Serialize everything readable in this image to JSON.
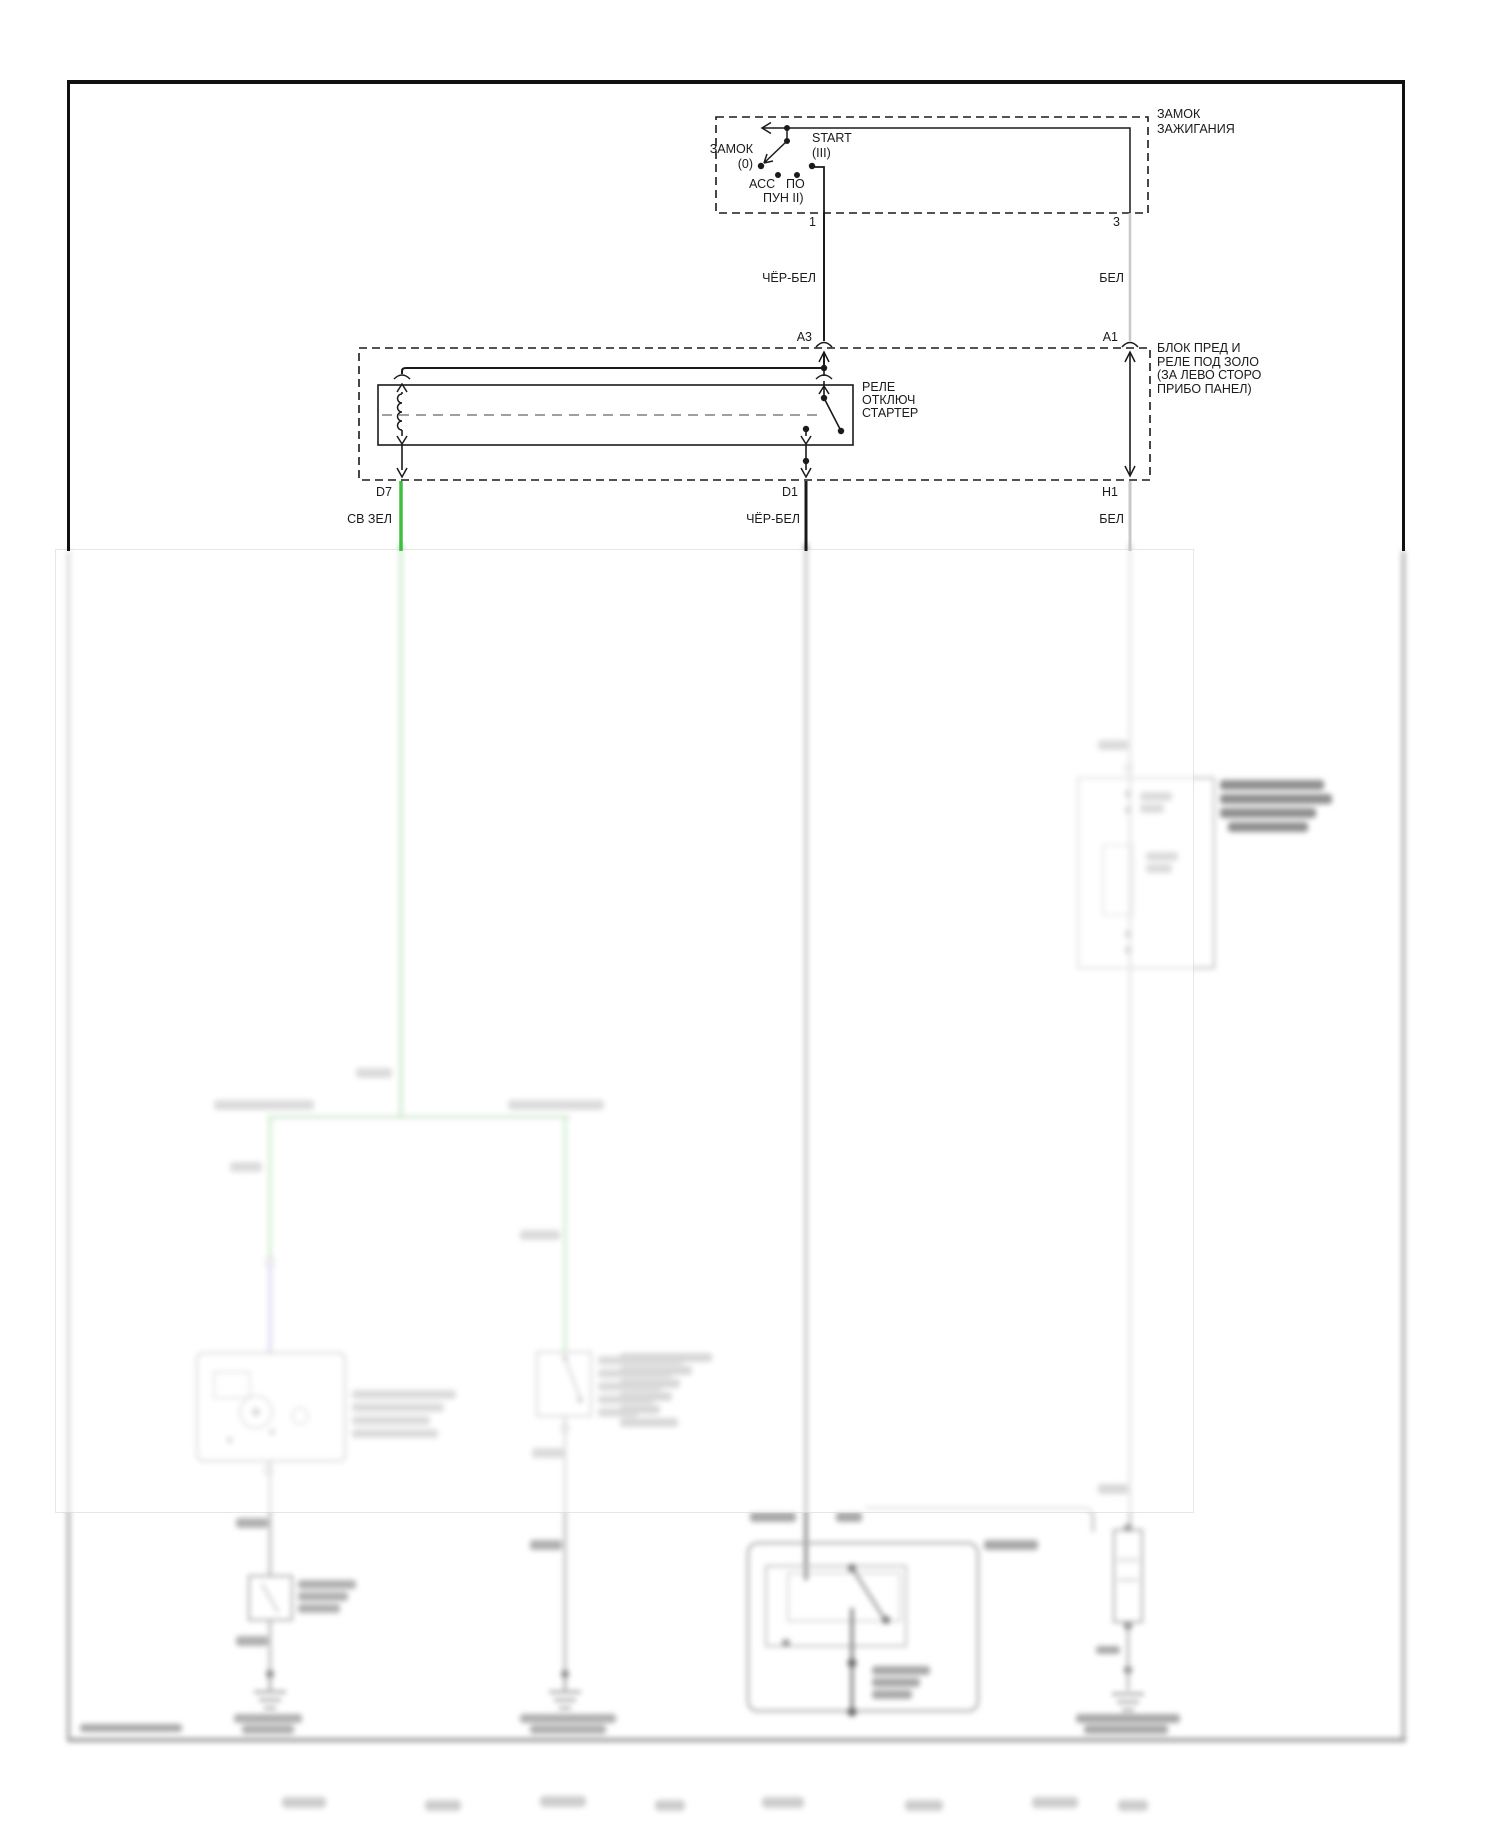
{
  "page": {
    "bg": "#ffffff",
    "frame_color": "#111111"
  },
  "colors": {
    "wire_green": "#3fbf3f",
    "wire_black_white": "#1a1a1a",
    "wire_white": "#c8c8c8",
    "blur_green": "#8fd48f",
    "blur_purple": "#a9a2d8"
  },
  "ignition_switch": {
    "title_line1": "ЗАМОК",
    "title_line2": "ЗАЖИГАНИЯ",
    "pos_lock_label": "ЗАМОК",
    "pos_lock_detent": "(0)",
    "pos_start_label": "START",
    "pos_start_detent": "(III)",
    "pos_acc_label": "АСС",
    "pos_po_label": "ПО",
    "pos_run_label": "ПУН II)",
    "pin_left": "1",
    "pin_right": "3"
  },
  "upper_wires": {
    "left_color_label": "ЧЁР-БЕЛ",
    "right_color_label": "БЕЛ"
  },
  "fuse_relay_block": {
    "title_line1": "БЛОК ПРЕД И",
    "title_line2": "РЕЛЕ ПОД ЗОЛО",
    "title_line3": "(ЗА ЛЕВО СТОРО",
    "title_line4": "ПРИБО ПАНЕЛ)",
    "pin_in_left": "A3",
    "pin_in_right": "A1",
    "pin_out_left": "D7",
    "pin_out_mid": "D1",
    "pin_out_right": "H1",
    "relay_line1": "РЕЛЕ",
    "relay_line2": "ОТКЛЮЧ",
    "relay_line3": "СТАРТЕР"
  },
  "lower_wires": {
    "left_color_label": "СВ ЗЕЛ",
    "mid_color_label": "ЧЁР-БЕЛ",
    "right_color_label": "БЕЛ"
  }
}
